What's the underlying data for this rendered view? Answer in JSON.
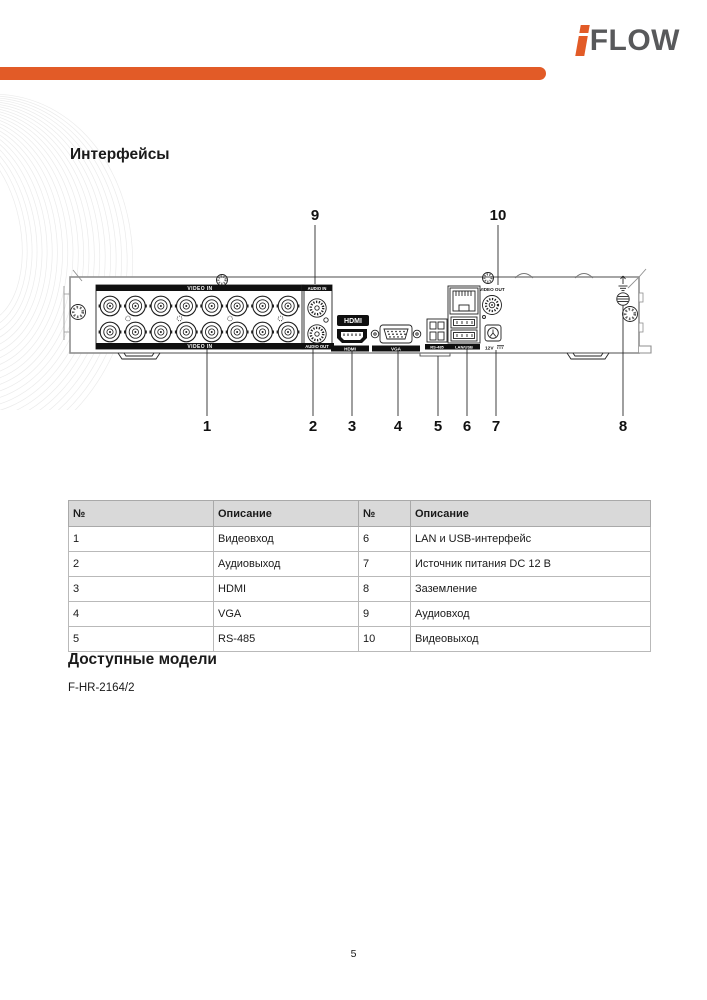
{
  "logo": {
    "text": "FLOW"
  },
  "headings": {
    "interfaces": "Интерфейсы",
    "models": "Доступные модели"
  },
  "model_text": "F-HR-2164/2",
  "diagram": {
    "labels": {
      "video_in": "VIDEO IN",
      "audio_in": "AUDIO IN",
      "audio_out": "AUDIO OUT",
      "hdmi_logo": "HDMI",
      "hdmi_port": "HDMI",
      "vga": "VGA",
      "rs485": "RS-485",
      "lan_usb": "LAN/USB",
      "video_out": "VIDEO OUT",
      "power": "12V"
    },
    "callouts": {
      "c1": "1",
      "c2": "2",
      "c3": "3",
      "c4": "4",
      "c5": "5",
      "c6": "6",
      "c7": "7",
      "c8": "8",
      "c9": "9",
      "c10": "10"
    }
  },
  "table": {
    "headers": [
      "№",
      "Описание",
      "№",
      "Описание"
    ],
    "rows": [
      [
        "1",
        "Видеовход",
        "6",
        "LAN и USB-интерфейс"
      ],
      [
        "2",
        "Аудиовыход",
        "7",
        "Источник питания DC 12 В"
      ],
      [
        "3",
        "HDMI",
        "8",
        "Заземление"
      ],
      [
        "4",
        "VGA",
        "9",
        "Аудиовход"
      ],
      [
        "5",
        "RS-485",
        "10",
        "Видеовыход"
      ]
    ]
  },
  "page": {
    "number": "5"
  },
  "colors": {
    "accent_orange": "#E25B27",
    "logo_gray": "#58595B",
    "table_header_bg": "#D9D9D9"
  }
}
